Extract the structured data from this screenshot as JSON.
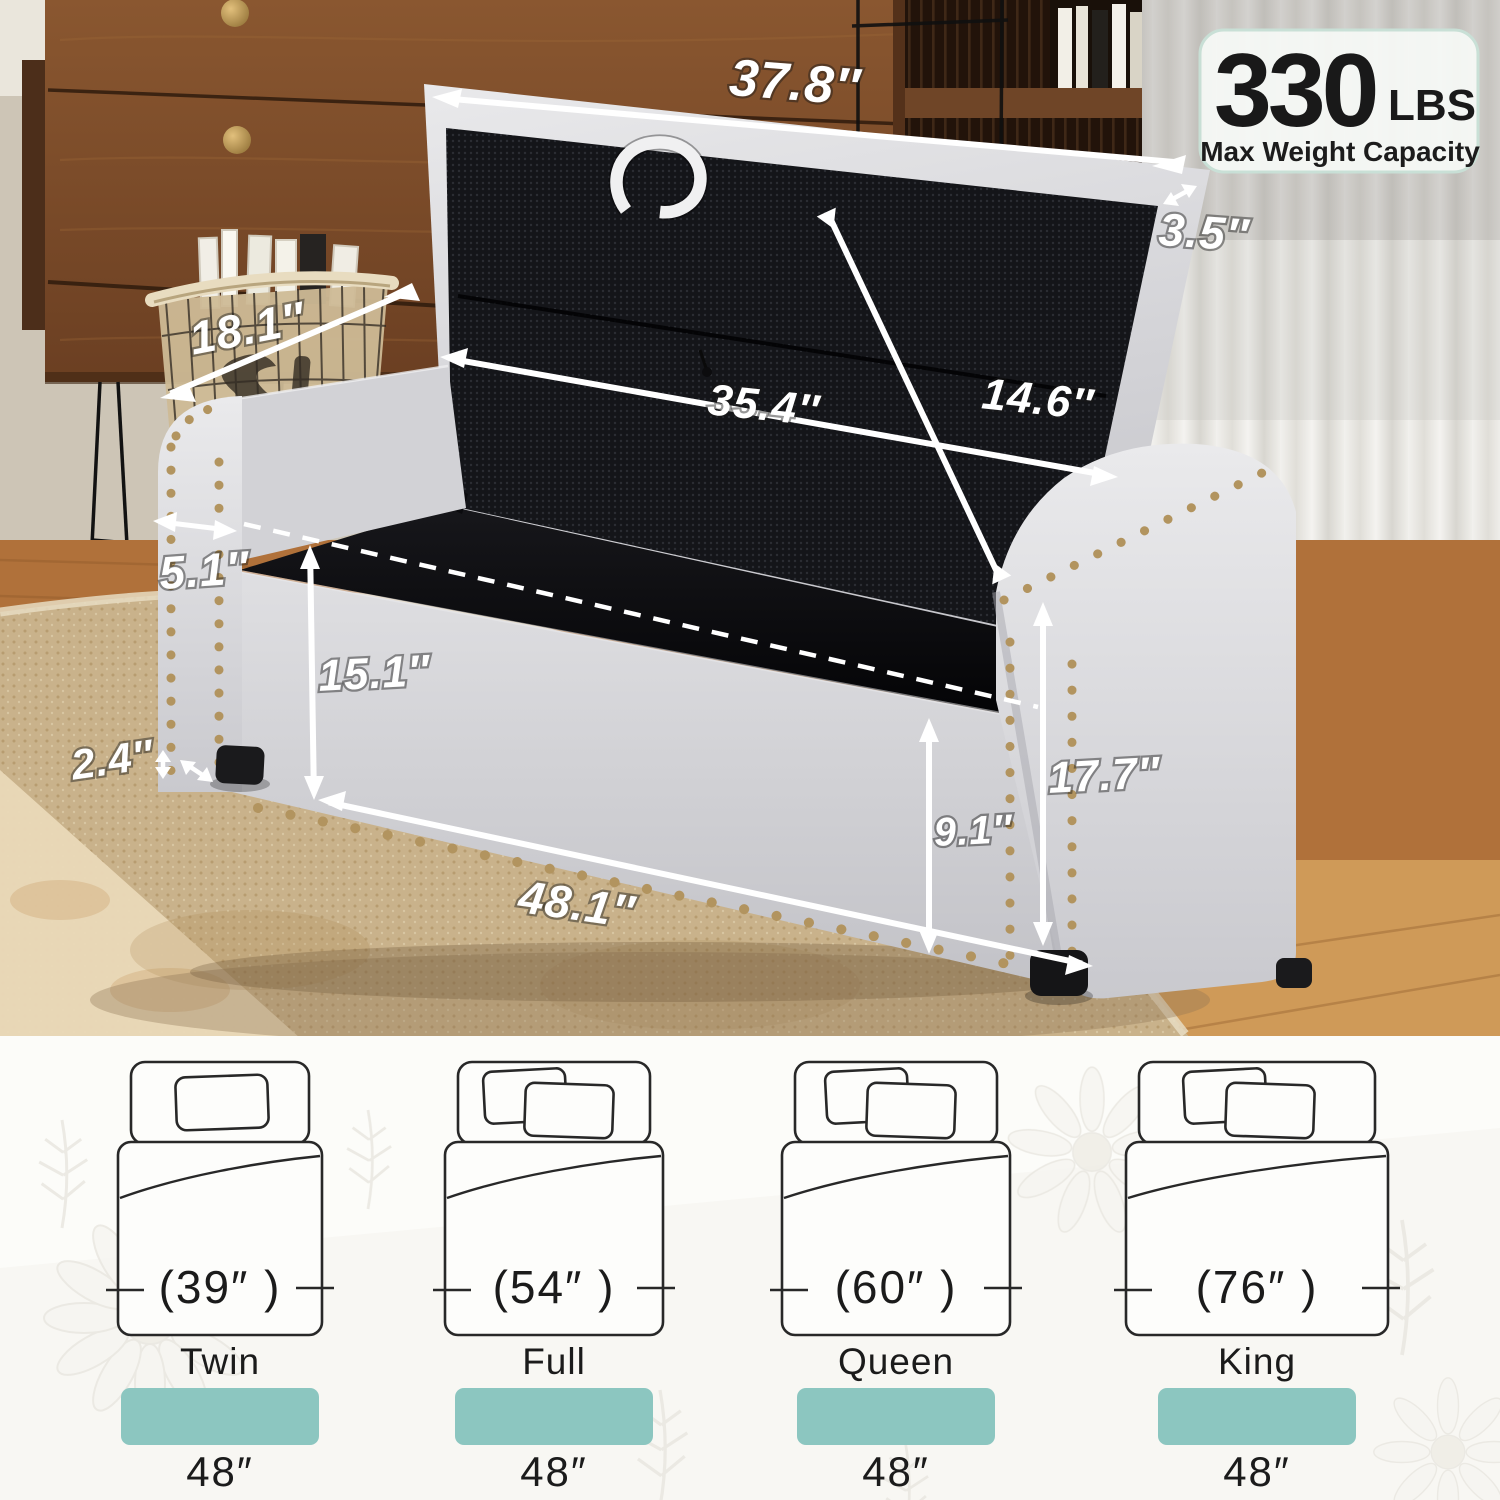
{
  "badge": {
    "value": "330",
    "unit": "LBS",
    "label": "Max Weight Capacity"
  },
  "dimensions": {
    "lid_width": "37.8″",
    "lid_thickness": "3.5″",
    "depth": "18.1″",
    "interior_width": "35.4″",
    "lid_interior_height": "14.6″",
    "arm_width": "5.1″",
    "interior_height": "15.1″",
    "leg_height": "2.4″",
    "overall_width": "48.1″",
    "storage_depth": "9.1″",
    "overall_height": "17.7″"
  },
  "beds": {
    "bar_color": "#8cc6c0",
    "items": [
      {
        "size": "Twin",
        "bed_width": "(39″ )",
        "ottoman_width": "48″"
      },
      {
        "size": "Full",
        "bed_width": "(54″ )",
        "ottoman_width": "48″"
      },
      {
        "size": "Queen",
        "bed_width": "(60″ )",
        "ottoman_width": "48″"
      },
      {
        "size": "King",
        "bed_width": "(76″ )",
        "ottoman_width": "48″"
      }
    ]
  },
  "colors": {
    "accent_teal": "#8cc6c0",
    "nailhead": "#b2945f"
  }
}
